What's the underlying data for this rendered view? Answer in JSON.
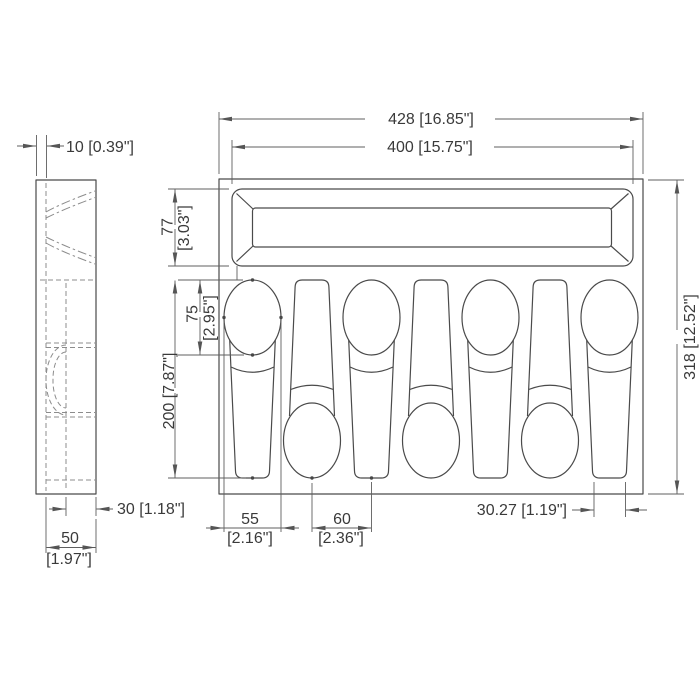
{
  "drawing": {
    "subject": "cutlery-tray-insert-technical-drawing",
    "dims": {
      "overall_width": "428 [16.85\"]",
      "slot_width": "400 [15.75\"]",
      "wall_thickness": "10 [0.39\"]",
      "slot_height": {
        "mm": "77",
        "inch": "[3.03\"]"
      },
      "bowl_length": {
        "mm": "75",
        "inch": "[2.95\"]"
      },
      "recess_length": "200 [7.87\"]",
      "overall_height": "318 [12.52\"]",
      "bowl_width": {
        "mm": "55",
        "inch": "[2.16\"]"
      },
      "spoon_pitch": {
        "mm": "60",
        "inch": "[2.36\"]"
      },
      "handle_end_width": "30.27 [1.19\"]",
      "recess_depth": "30 [1.18\"]",
      "side_width": {
        "mm": "50",
        "inch": "[1.97\"]"
      }
    }
  }
}
